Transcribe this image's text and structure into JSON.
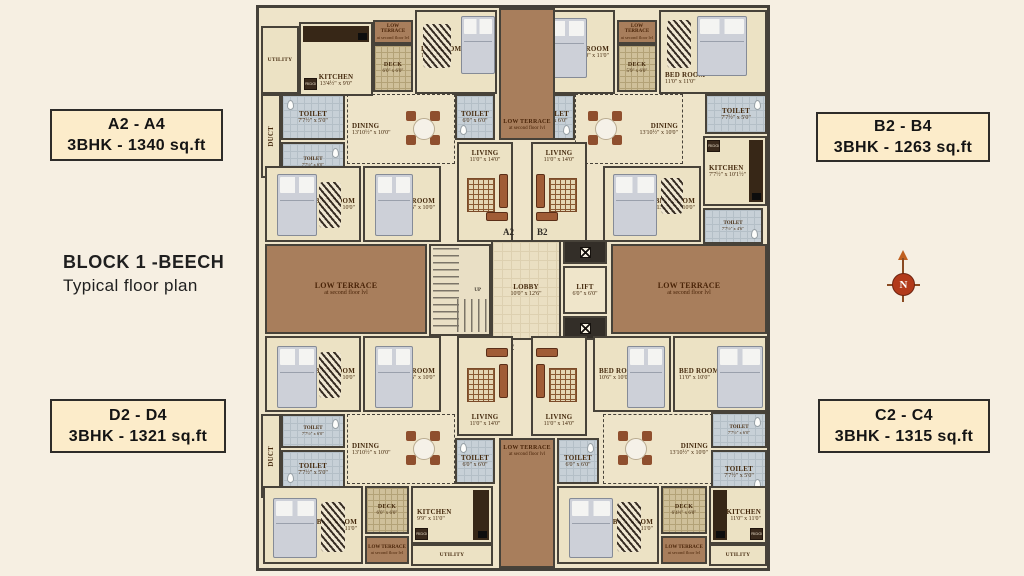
{
  "block": {
    "title": "BLOCK 1 -BEECH",
    "subtitle": "Typical floor plan"
  },
  "side_labels": {
    "a": {
      "range": "A2 - A4",
      "spec": "3BHK - 1340 sq.ft"
    },
    "b": {
      "range": "B2 - B4",
      "spec": "3BHK - 1263 sq.ft"
    },
    "d": {
      "range": "D2 - D4",
      "spec": "3BHK - 1321 sq.ft"
    },
    "c": {
      "range": "C2 - C4",
      "spec": "3BHK - 1315 sq.ft"
    }
  },
  "compass": {
    "label": "N"
  },
  "core": {
    "lobby": {
      "name": "LOBBY",
      "dim": "10'0\" x 12'6\""
    },
    "lift": {
      "name": "LIFT",
      "dim": "6'0\" x 6'0\""
    },
    "stairs_up": "UP",
    "markers": {
      "a2": "A2",
      "b2": "B2",
      "d2": "D2",
      "c2": "C2"
    }
  },
  "terrace": {
    "name": "LOW TERRACE",
    "sub": "at second floor lvl"
  },
  "labels": {
    "fridge": "FRIDGE"
  },
  "units": {
    "a": {
      "utility": {
        "name": "UTILITY"
      },
      "kitchen": {
        "name": "KITCHEN",
        "dim": "13'4½\" x 9'0\""
      },
      "deck": {
        "name": "DECK",
        "dim": "6'0\" x 6'0\""
      },
      "bed1": {
        "name": "BED ROOM",
        "dim": "13'0\" x 11'0\""
      },
      "toilet1": {
        "name": "TOILET",
        "dim": "7'7½\" x 5'0\""
      },
      "duct": {
        "name": "DUCT"
      },
      "toilet2": {
        "name": "TOILET",
        "dim": "7'7½\" x 6'0\""
      },
      "dining": {
        "name": "DINING",
        "dim": "13'10½\" x 10'0\""
      },
      "toilet3": {
        "name": "TOILET",
        "dim": "6'0\" x 6'0\""
      },
      "living": {
        "name": "LIVING",
        "dim": "11'0\" x 14'0\""
      },
      "bed2": {
        "name": "BED ROOM",
        "dim": "13'0\" x 10'0\""
      },
      "bed3": {
        "name": "BED ROOM",
        "dim": "10'6\" x 10'0\""
      }
    },
    "b": {
      "bed1": {
        "name": "BED ROOM",
        "dim": "10'0\" x 11'0\""
      },
      "deck": {
        "name": "DECK",
        "dim": "5'9\" x 6'0\""
      },
      "bed2": {
        "name": "BED ROOM",
        "dim": "11'0\" x 11'0\""
      },
      "toilet1": {
        "name": "TOILET",
        "dim": "6'0\" x 6'0\""
      },
      "toilet2": {
        "name": "TOILET",
        "dim": "7'7½\" x 5'0\""
      },
      "kitchen": {
        "name": "KITCHEN",
        "dim": "7'7½\" x 10'1½\""
      },
      "toilet3": {
        "name": "TOILET",
        "dim": "7'7½\" x 4'6\""
      },
      "dining": {
        "name": "DINING",
        "dim": "13'10½\" x 10'0\""
      },
      "living": {
        "name": "LIVING",
        "dim": "11'0\" x 14'0\""
      },
      "bed3": {
        "name": "BED ROOM",
        "dim": "13'10½\" x 10'0\""
      }
    },
    "d": {
      "bed1": {
        "name": "BED ROOM",
        "dim": "13'0\" x 10'0\""
      },
      "bed2": {
        "name": "BED ROOM",
        "dim": "10'6\" x 10'0\""
      },
      "living": {
        "name": "LIVING",
        "dim": "11'0\" x 14'0\""
      },
      "toilet1": {
        "name": "TOILET",
        "dim": "7'7½\" x 6'0\""
      },
      "duct": {
        "name": "DUCT"
      },
      "toilet2": {
        "name": "TOILET",
        "dim": "7'7½\" x 5'0\""
      },
      "dining": {
        "name": "DINING",
        "dim": "13'10½\" x 10'0\""
      },
      "toilet3": {
        "name": "TOILET",
        "dim": "6'0\" x 6'0\""
      },
      "bed3": {
        "name": "BED ROOM",
        "dim": "13'0\" x 11'0\""
      },
      "deck": {
        "name": "DECK",
        "dim": "6'0\" x 6'0\""
      },
      "kitchen": {
        "name": "KITCHEN",
        "dim": "9'9\" x 11'0\""
      },
      "utility": {
        "name": "UTILITY"
      }
    },
    "c": {
      "living": {
        "name": "LIVING",
        "dim": "11'0\" x 14'0\""
      },
      "bed1": {
        "name": "BED ROOM",
        "dim": "10'6\" x 10'0\""
      },
      "bed2": {
        "name": "BED ROOM",
        "dim": "11'0\" x 10'0\""
      },
      "toilet1": {
        "name": "TOILET",
        "dim": "6'0\" x 6'0\""
      },
      "dining": {
        "name": "DINING",
        "dim": "13'10½\" x 10'0\""
      },
      "toilet2": {
        "name": "TOILET",
        "dim": "7'7½\" x 6'0\""
      },
      "toilet3": {
        "name": "TOILET",
        "dim": "7'7½\" x 5'0\""
      },
      "bed3": {
        "name": "BED ROOM",
        "dim": "13'0\" x 11'0\""
      },
      "deck": {
        "name": "DECK",
        "dim": "6'4½\" x 6'0\""
      },
      "kitchen": {
        "name": "KITCHEN",
        "dim": "11'0\" x 11'0\""
      },
      "utility": {
        "name": "UTILITY"
      }
    }
  },
  "colors": {
    "page_bg": "#f6efe2",
    "plan_floor": "#ece2c4",
    "wall": "#474239",
    "terrace": "#a87e5c",
    "wet_floor": "#c7d0d7",
    "deck_floor": "#cfc09a",
    "label_box_bg": "#fcecca",
    "compass_red": "#b23a1b"
  }
}
